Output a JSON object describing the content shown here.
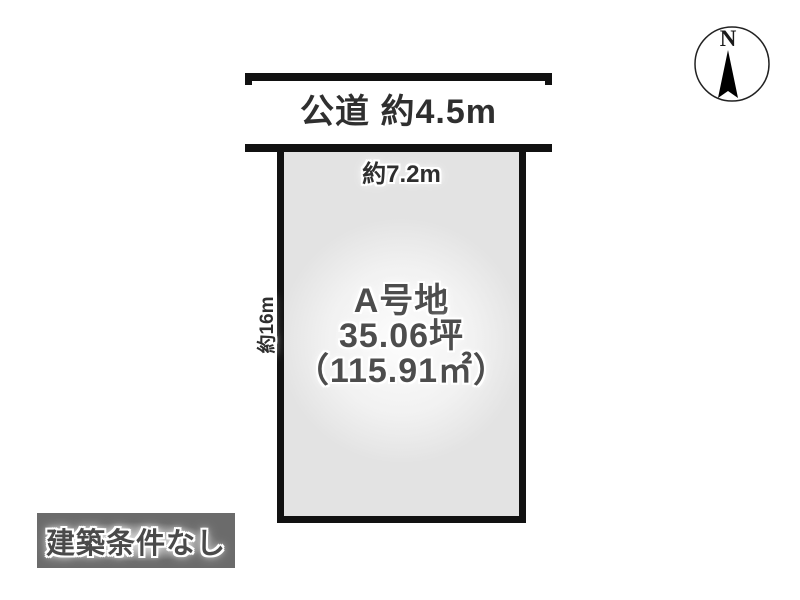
{
  "road": {
    "label": "公道 約4.5m"
  },
  "plot": {
    "title_line1": "A号地",
    "title_line2": "35.06坪",
    "title_line3": "（115.91㎡）",
    "width_label": "約7.2m",
    "depth_label": "約16m"
  },
  "compass": {
    "north_label": "N"
  },
  "badge": {
    "label": "建築条件なし"
  },
  "colors": {
    "ink": "#111111",
    "text-dark": "#2f2f2f",
    "title-gray": "#4d4d4d",
    "plot-fill": "#e3e3e3",
    "plot-glow": "#fdfdfd",
    "badge-bg": "#6b6b6b",
    "badge-text": "#4a4a4a"
  }
}
